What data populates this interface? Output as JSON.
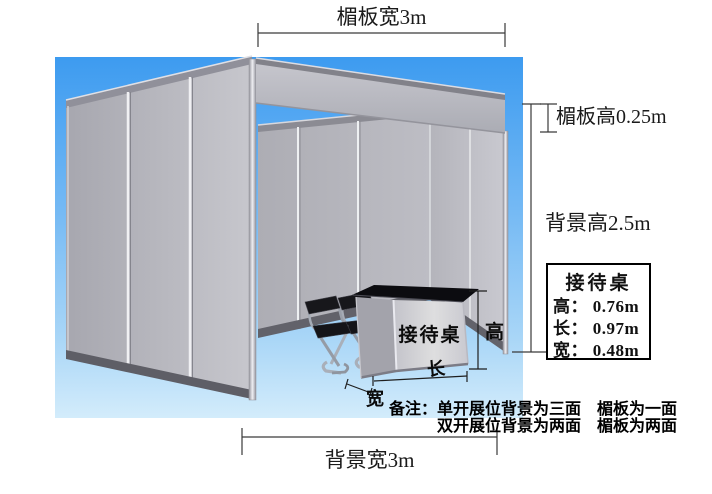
{
  "diagram": {
    "top_dimension": "楣板宽3m",
    "lintel_height_dimension": "楣板高0.25m",
    "background_height_dimension": "背景高2.5m",
    "background_width_dimension": "背景宽3m"
  },
  "reception_desk": {
    "surface_label": "接待桌",
    "height_arrow_label": "高",
    "length_arrow_label": "长",
    "width_arrow_label": "宽"
  },
  "info_box": {
    "title": "接待桌",
    "rows": [
      "高： 0.76m",
      "长： 0.97m",
      "宽： 0.48m"
    ]
  },
  "notes": {
    "line1": "备注：单开展位背景为三面　楣板为一面",
    "line2": "双开展位背景为两面　楣板为两面"
  },
  "colors": {
    "sky_top": "#3d9bf0",
    "sky_bottom": "#d3ecfb",
    "panel_gray": "#b9b9c0",
    "frame_dark": "#62626a",
    "desk_top": "#0c0c10",
    "text": "#111111"
  }
}
